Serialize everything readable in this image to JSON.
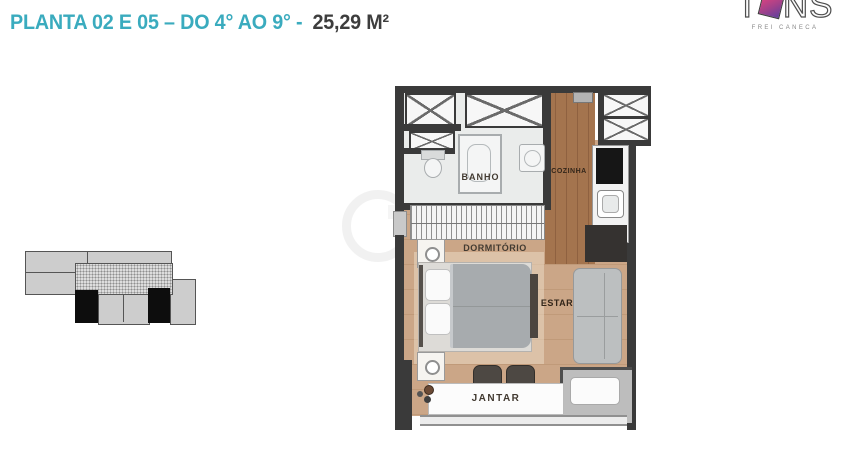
{
  "header": {
    "title_plan": "PLANTA 02 E 05 – DO 4° AO 9° -",
    "title_area": "25,29 M²"
  },
  "logo": {
    "part1": "T",
    "part2": "NS",
    "subtext": "FREI CANECA"
  },
  "rooms": {
    "bath": "BANHO",
    "kitchen": "COZINHA",
    "bedroom": "DORMITÓRIO",
    "living": "ESTAR",
    "dining": "JANTAR"
  },
  "colors": {
    "accent_teal": "#3aabbe",
    "title_dark": "#3d3d3d",
    "wall": "#3a3a3a",
    "kitchen_wood": "#a4744e",
    "floor_tan": "#cba687",
    "logo_gradient_start": "#e1447e",
    "logo_gradient_end": "#5f3f9e"
  }
}
